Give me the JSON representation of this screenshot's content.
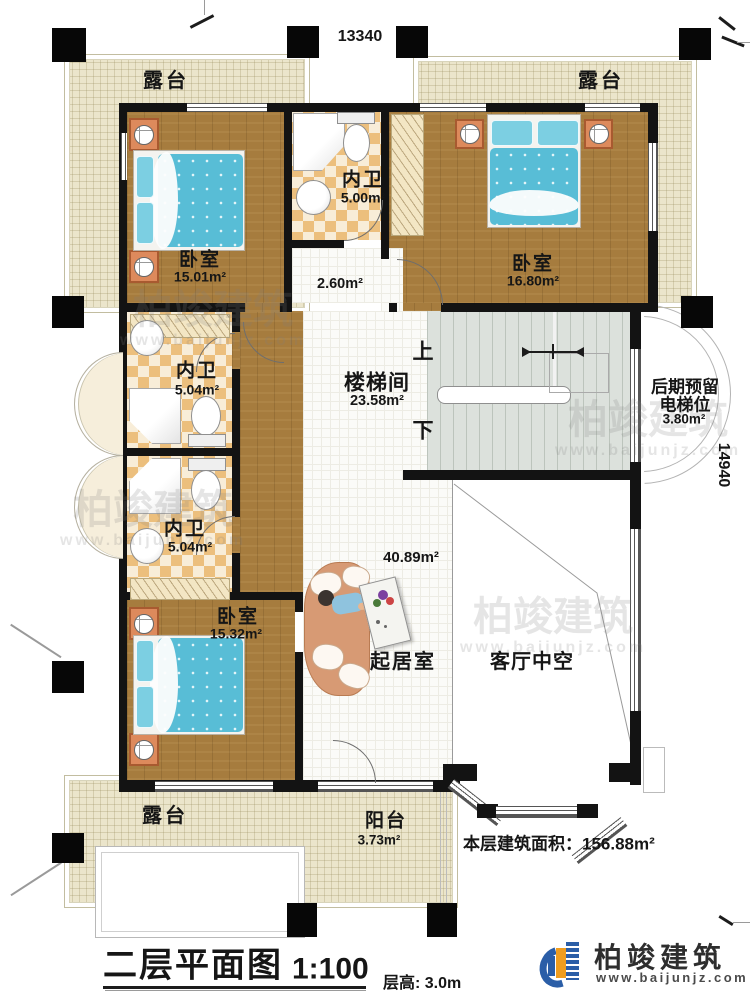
{
  "plan": {
    "dim_top": "13340",
    "dim_right": "14940",
    "rooms": {
      "terrace_tl": "露台",
      "terrace_tr": "露台",
      "terrace_bl": "露台",
      "balcony_name": "阳台",
      "balcony_area": "3.73m²",
      "bedroom_tl_name": "卧室",
      "bedroom_tl_area": "15.01m²",
      "bath_top_name": "内卫",
      "bath_top_area": "5.00m²",
      "bedroom_tr_name": "卧室",
      "bedroom_tr_area": "16.80m²",
      "corridor_area": "2.60m²",
      "stairhall_name": "楼梯间",
      "stairhall_area": "23.58m²",
      "elevator_line1": "后期预留",
      "elevator_line2": "电梯位",
      "elevator_area": "3.80m²",
      "bath_mid_name": "内卫",
      "bath_mid_area": "5.04m²",
      "bath_low_name": "内卫",
      "bath_low_area": "5.04m²",
      "bedroom_bl_name": "卧室",
      "bedroom_bl_area": "15.32m²",
      "living_name": "起居室",
      "living_area": "40.89m²",
      "void_name": "客厅中空"
    },
    "stairs": {
      "up": "上",
      "down": "下"
    },
    "floor_area_note": "本层建筑面积：156.88m²",
    "title": {
      "main": "二层平面图",
      "scale": "1:100",
      "floor_height": "层高: 3.0m"
    }
  },
  "logo": {
    "name": "柏竣建筑",
    "url": "www.baijunjz.com"
  },
  "watermark": {
    "text": "柏竣建筑",
    "url": "www.baijunjz.com"
  },
  "colors": {
    "wall": "#131313",
    "wood": "#a67c3e",
    "checker_tan": "#ecbf7d",
    "terrace": "#ebe5cb",
    "stair": "#dce1dc",
    "bed": "#58bdd6",
    "logo_blue": "#2b5ea7",
    "logo_orange": "#f09d1e"
  }
}
